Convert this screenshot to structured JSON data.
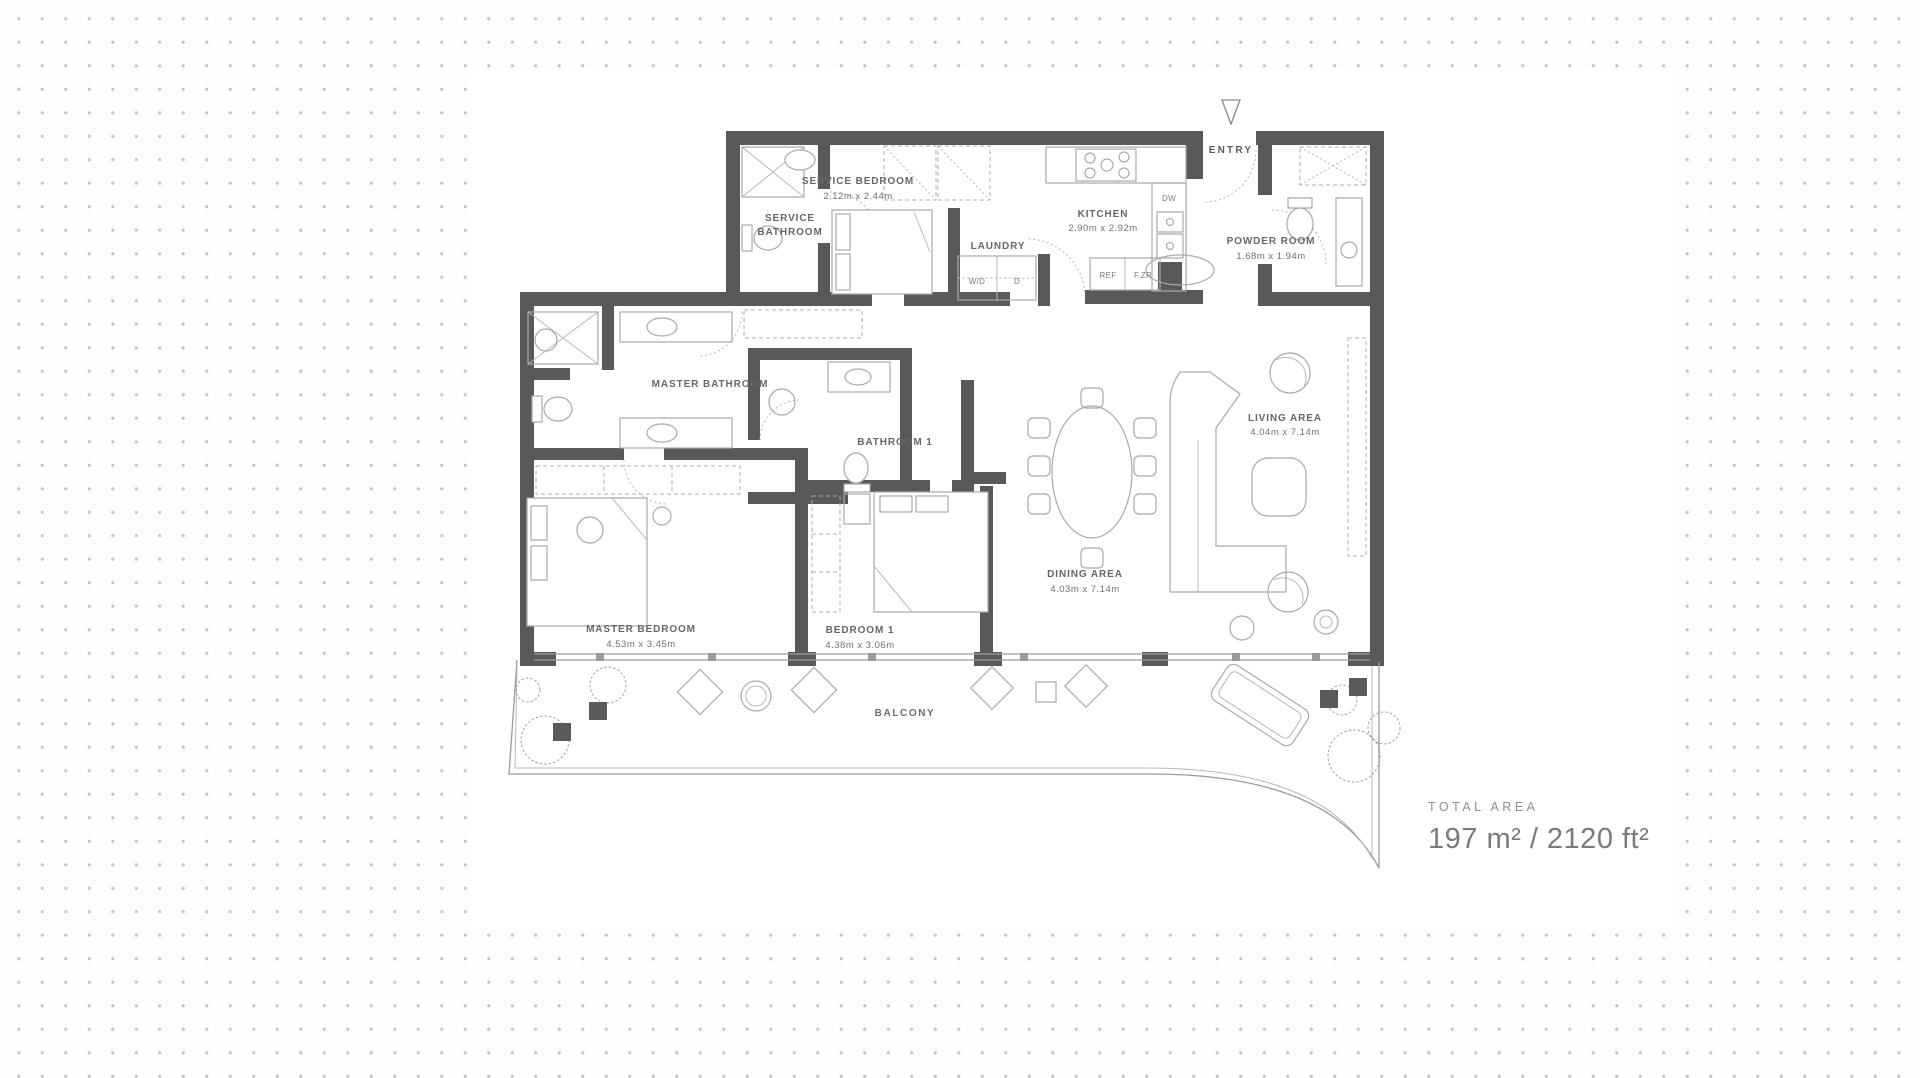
{
  "background": {
    "dot_color": "#c6c6c6",
    "sheet_color": "#ffffff",
    "wall_color": "#595959"
  },
  "plan": {
    "labels": {
      "entry": "ENTRY",
      "service_bedroom": {
        "name": "SERVICE BEDROOM",
        "dims": "2.12m x 2.44m"
      },
      "service_bathroom": {
        "line1": "SERVICE",
        "line2": "BATHROOM"
      },
      "laundry": {
        "name": "LAUNDRY"
      },
      "kitchen": {
        "name": "KITCHEN",
        "dims": "2.90m x 2.92m"
      },
      "powder_room": {
        "name": "POWDER ROOM",
        "dims": "1.68m x 1.94m"
      },
      "master_bathroom": {
        "name": "MASTER BATHROOM"
      },
      "bathroom_1": {
        "name": "BATHROOM 1"
      },
      "master_bedroom": {
        "name": "MASTER BEDROOM",
        "dims": "4.53m x 3.45m"
      },
      "bedroom_1": {
        "name": "BEDROOM 1",
        "dims": "4.38m x 3.06m"
      },
      "dining_area": {
        "name": "DINING AREA",
        "dims": "4.03m x 7.14m"
      },
      "living_area": {
        "name": "LIVING AREA",
        "dims": "4.04m x 7.14m"
      },
      "balcony": {
        "name": "BALCONY"
      }
    },
    "appliances": {
      "washer_dryer": "W/D",
      "dryer": "D",
      "fridge": "REF",
      "freezer": "F.ZR",
      "dishwasher": "DW"
    }
  },
  "total_area": {
    "label": "TOTAL AREA",
    "value": "197 m² / 2120 ft²"
  }
}
